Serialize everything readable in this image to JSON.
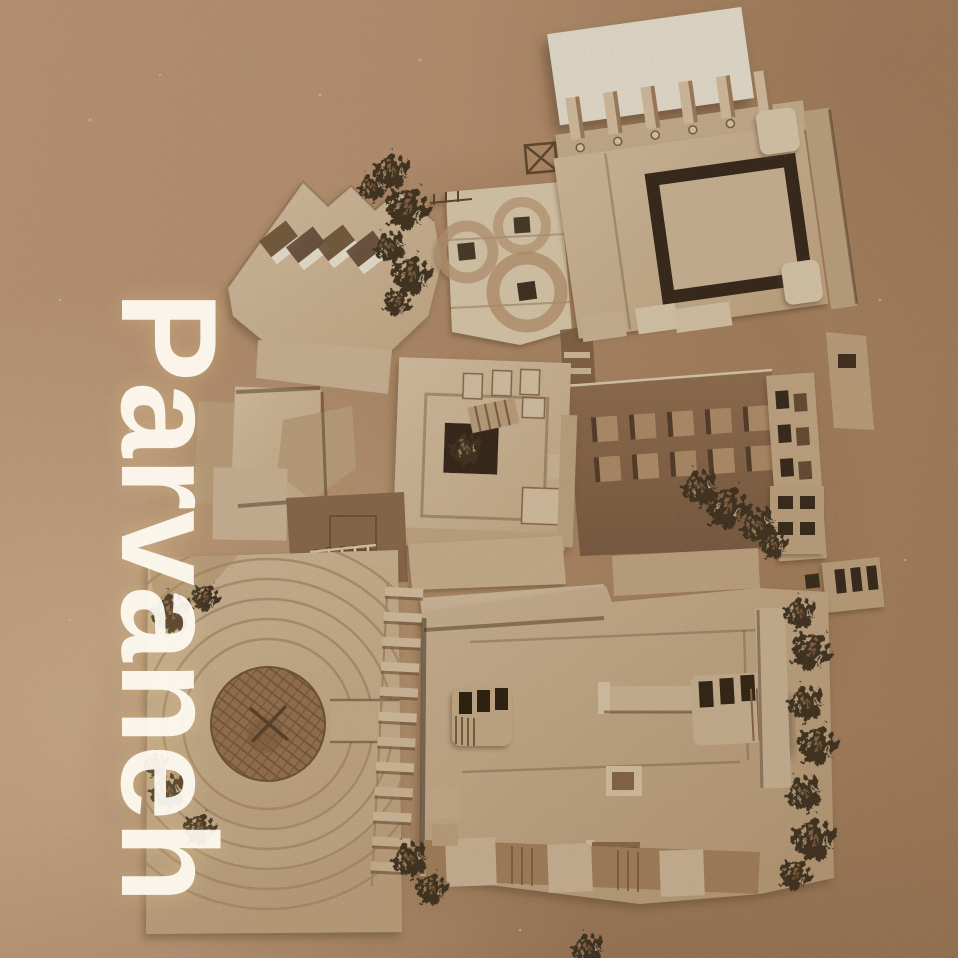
{
  "overlay": {
    "title": "Parvaneh"
  },
  "palette": {
    "cardboard": "#d9bd9a",
    "cardboard_light": "#e8d4b2",
    "cardboard_dark": "#c7a77e",
    "paper": "#f7eedb",
    "deep_shadow": "#2e1d0d",
    "courtyard": "#8d6645",
    "foliage": "#3a2a18",
    "ink": "#4f351b",
    "text": "#fffcf4",
    "background": "#c0956f",
    "background_light": "#dab385",
    "background_dark": "#a47a52"
  },
  "scene": {
    "type": "sepia-photo-of-architectural-model",
    "view": "aerial-top-down",
    "objects": [
      "white-paper-sheet",
      "colonnade-fins",
      "atrium-courtyard-building",
      "sawtooth-roof-with-skylights",
      "round-skylight-roof",
      "central-courtyard-block",
      "sunken-courtyard-panel-grid",
      "window-slot-strip",
      "vent-boxes",
      "south-roof-building",
      "rooftop-skylight-boxes",
      "circular-plaza-with-rings",
      "crosshatched-center-circle",
      "stair-ladder-strip",
      "railing",
      "foliage-clusters",
      "crossed-square-mark"
    ]
  }
}
